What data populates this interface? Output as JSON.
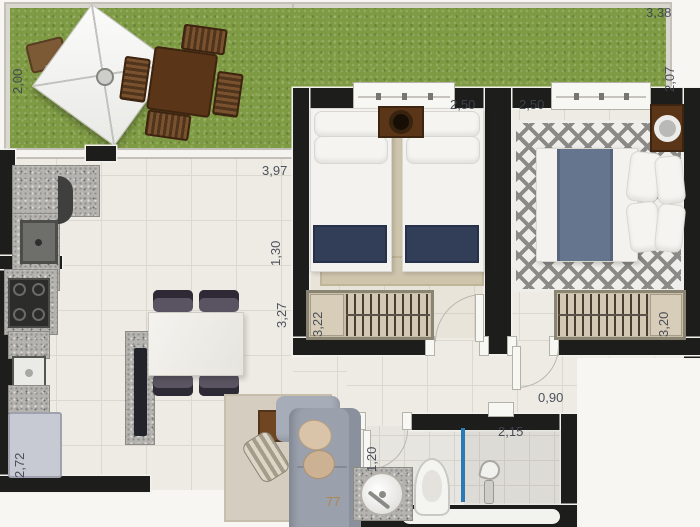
{
  "title": "apartment-floor-plan",
  "labels": {
    "garden_depth_left": "2,00",
    "garden_width": "3,38",
    "garden_depth_right": "2,07",
    "living_width": "3,97",
    "kitchen_opening": "1,30",
    "living_length": "3,27",
    "bedroom1_width": "2,50",
    "bedroom2_width": "2,50",
    "bedroom1_length": "3,22",
    "bedroom2_length": "3,20",
    "kitchen_length": "2,72",
    "hall_width": "0,90",
    "bath_door_width": "1,20",
    "bath_width": "2,15",
    "sofa_dim_partial": "77"
  },
  "palette": {
    "wall": "#1d1d1c",
    "grass": "#7e9a43",
    "floor_tile": "#edebe4",
    "label_text": "#3f4450",
    "label_tan": "#b08347",
    "shower_glass_blue": "#2a7ab5",
    "bed1_runner_navy": "#323d58",
    "bed2_runner_gray": "#66758e",
    "wood_brown": "#5b3517",
    "granite_gray": "#b4b3af",
    "fridge_lavender": "#c7c9d3"
  }
}
